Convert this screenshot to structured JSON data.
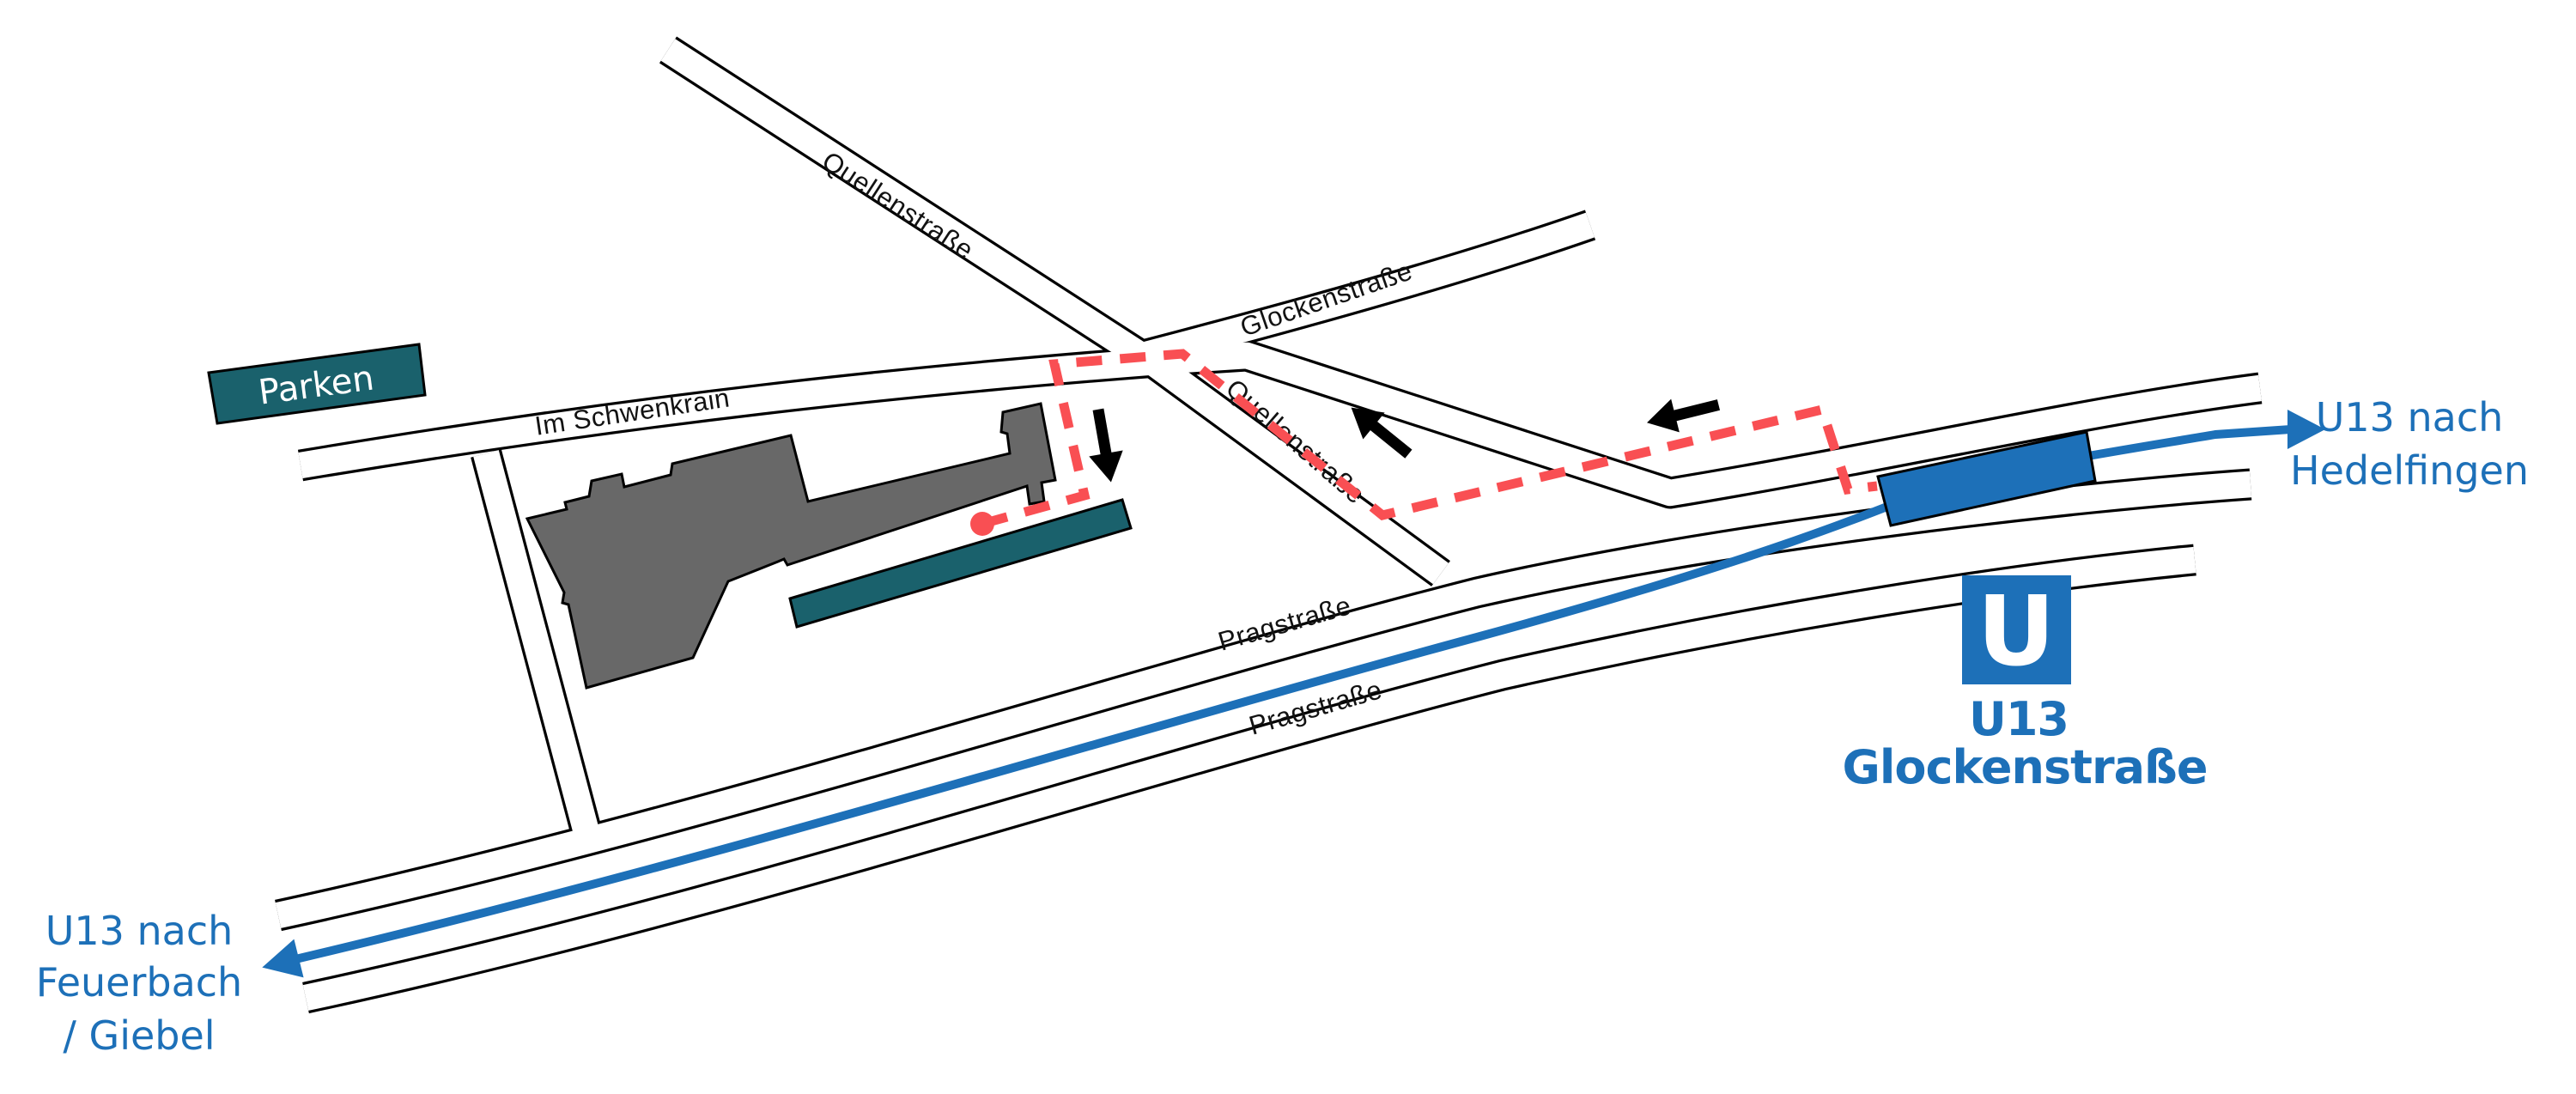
{
  "colors": {
    "blue": "#1d70b8",
    "red": "#f94f53",
    "teal": "#1a616c",
    "gray": "#686868"
  },
  "parking": {
    "label": "Parken"
  },
  "streets": {
    "im_schwenkrain": "Im Schwenkrain",
    "quellenstrasse_upper": "Quellenstraße",
    "quellenstrasse_lower": "Quellenstraße",
    "glockenstrasse": "Glockenstraße",
    "pragstrasse_upper": "Pragstraße",
    "pragstrasse_lower": "Pragstraße"
  },
  "station": {
    "logo_letter": "U",
    "line": "U13",
    "name": "Glockenstraße"
  },
  "directions": {
    "hedelfingen_line1": "U13 nach",
    "hedelfingen_line2": "Hedelfingen",
    "feuerbach_line1": "U13 nach",
    "feuerbach_line2": "Feuerbach",
    "feuerbach_line3": "/ Giebel"
  },
  "icons": {
    "entrance_marker": "red-dot",
    "walking_direction": "black-arrow",
    "tram_direction": "blue-arrow",
    "station_logo": "u-in-blue-square"
  }
}
